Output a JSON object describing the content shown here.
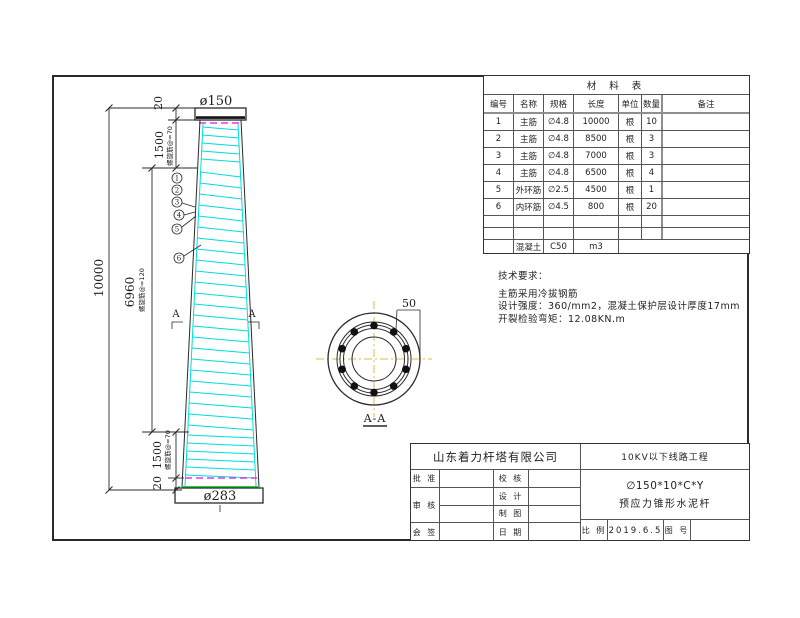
{
  "colors": {
    "spiral": "#00dcdc",
    "edge_green": "#1fd43c",
    "tie_magenta": "#e03ce0",
    "centerline_yellow": "#d8c23a",
    "thick_gray": "#8f8f8f"
  },
  "drawing": {
    "pole": {
      "top_diameter": "ø150",
      "bottom_diameter": "ø283",
      "dim_total": "10000",
      "dim_mid": "6960",
      "dim_mid_note": "螺旋筋@=120",
      "dim_top_cap": "20",
      "dim_top_segment": "1500",
      "dim_top_note": "螺旋筋@=70",
      "dim_bottom_segment": "1500",
      "dim_bottom_note": "螺旋筋@=70",
      "dim_bottom_cap": "20",
      "callouts": [
        "1",
        "2",
        "3",
        "4",
        "5",
        "6"
      ],
      "section_marker": "A"
    },
    "section": {
      "label": "A-A",
      "dim_wall": "50"
    }
  },
  "materials_table": {
    "title": "材 料 表",
    "headers": [
      "编号",
      "名称",
      "规格",
      "长度",
      "单位",
      "数量",
      "备注"
    ],
    "rows": [
      [
        "1",
        "主筋",
        "∅4.8",
        "10000",
        "根",
        "10",
        ""
      ],
      [
        "2",
        "主筋",
        "∅4.8",
        "8500",
        "根",
        "3",
        ""
      ],
      [
        "3",
        "主筋",
        "∅4.8",
        "7000",
        "根",
        "3",
        ""
      ],
      [
        "4",
        "主筋",
        "∅4.8",
        "6500",
        "根",
        "4",
        ""
      ],
      [
        "5",
        "外环筋",
        "∅2.5",
        "4500",
        "根",
        "1",
        ""
      ],
      [
        "6",
        "内环筋",
        "∅4.5",
        "800",
        "根",
        "20",
        ""
      ]
    ],
    "footer": {
      "name": "混凝土",
      "spec": "C50",
      "qty": "m3"
    }
  },
  "tech_notes": {
    "title": "技术要求：",
    "lines": [
      "主筋采用冷拔钢筋",
      "设计强度：360/mm2，混凝土保护层设计厚度17mm",
      "开裂检验弯矩：12.08KN.m"
    ]
  },
  "title_block": {
    "company": "山东着力杆塔有限公司",
    "project": "10KV以下线路工程",
    "product_code": "∅150*10*C*Y",
    "product_name": "预应力锥形水泥杆",
    "labels": {
      "approve": "批 准",
      "check": "校 核",
      "review": "审 核",
      "design": "设 计",
      "draft": "制 图",
      "countersign": "会 签",
      "date": "日 期",
      "scale": "比 例",
      "drawing_no": "图 号"
    },
    "date_value": "2019.6.5"
  }
}
